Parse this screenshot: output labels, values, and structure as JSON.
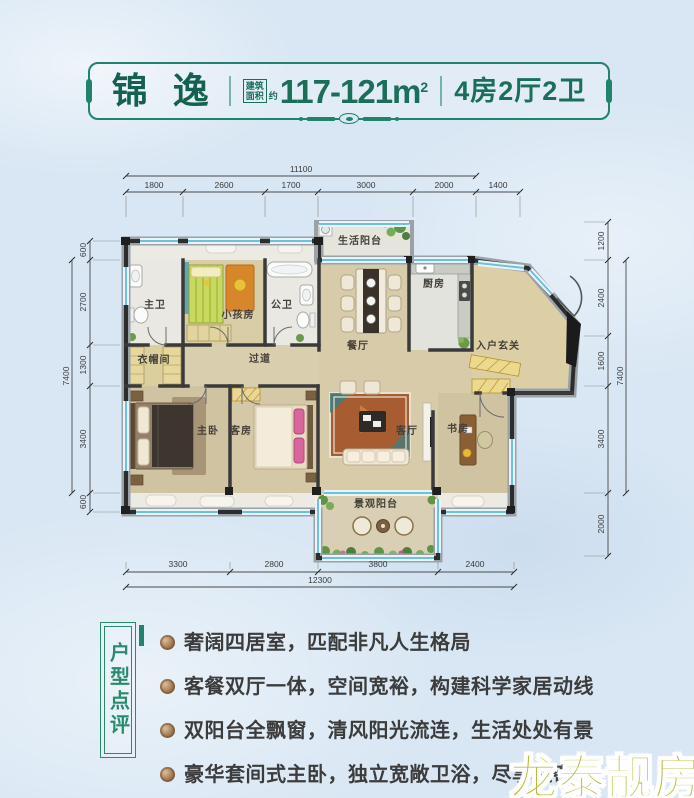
{
  "header": {
    "title": "锦 逸",
    "area_box": [
      "建筑",
      "面积"
    ],
    "approx": "约",
    "area": "117-121m",
    "area_exp": "2",
    "spec": "4房2厅2卫"
  },
  "plan": {
    "rooms": {
      "master_bath": "主卫",
      "kids_room": "小孩房",
      "public_bath": "公卫",
      "cloakroom": "衣帽间",
      "corridor": "过道",
      "life_balcony": "生活阳台",
      "kitchen": "厨房",
      "dining": "餐厅",
      "foyer": "入户玄关",
      "master_bedroom": "主卧",
      "guest_room": "客房",
      "living_room": "客厅",
      "study": "书房",
      "view_balcony": "景观阳台"
    },
    "dims": {
      "top_total": "11100",
      "top": [
        "1800",
        "2600",
        "1700",
        "3000",
        "2000",
        "1400"
      ],
      "left": [
        "600",
        "2700",
        "1300",
        "3400",
        "600"
      ],
      "left_total": "7400",
      "right": [
        "1200",
        "2400",
        "1600",
        "3400",
        "2000"
      ],
      "right_total": "7400",
      "bottom": [
        "3300",
        "2800",
        "3800",
        "2400"
      ],
      "bottom_total": "12300"
    }
  },
  "review": {
    "label": "户型点评",
    "points": [
      "奢阔四居室，匹配非凡人生格局",
      "客餐双厅一体，空间宽裕，构建科学家居动线",
      "双阳台全飘窗，清风阳光流连，生活处处有景",
      "豪华套间式主卧，独立宽敞卫浴，尽享私密"
    ]
  },
  "watermark": "龙泰靓房",
  "colors": {
    "accent_green": "#20836b",
    "text_dark": "#3c3c3c",
    "watermark_olive": "#b6bd3b",
    "wall": "#2d2d2d",
    "floor_tan": "#d2c5a4",
    "glass_blue": "#6fc0dd",
    "background": "#d9e7f4"
  }
}
